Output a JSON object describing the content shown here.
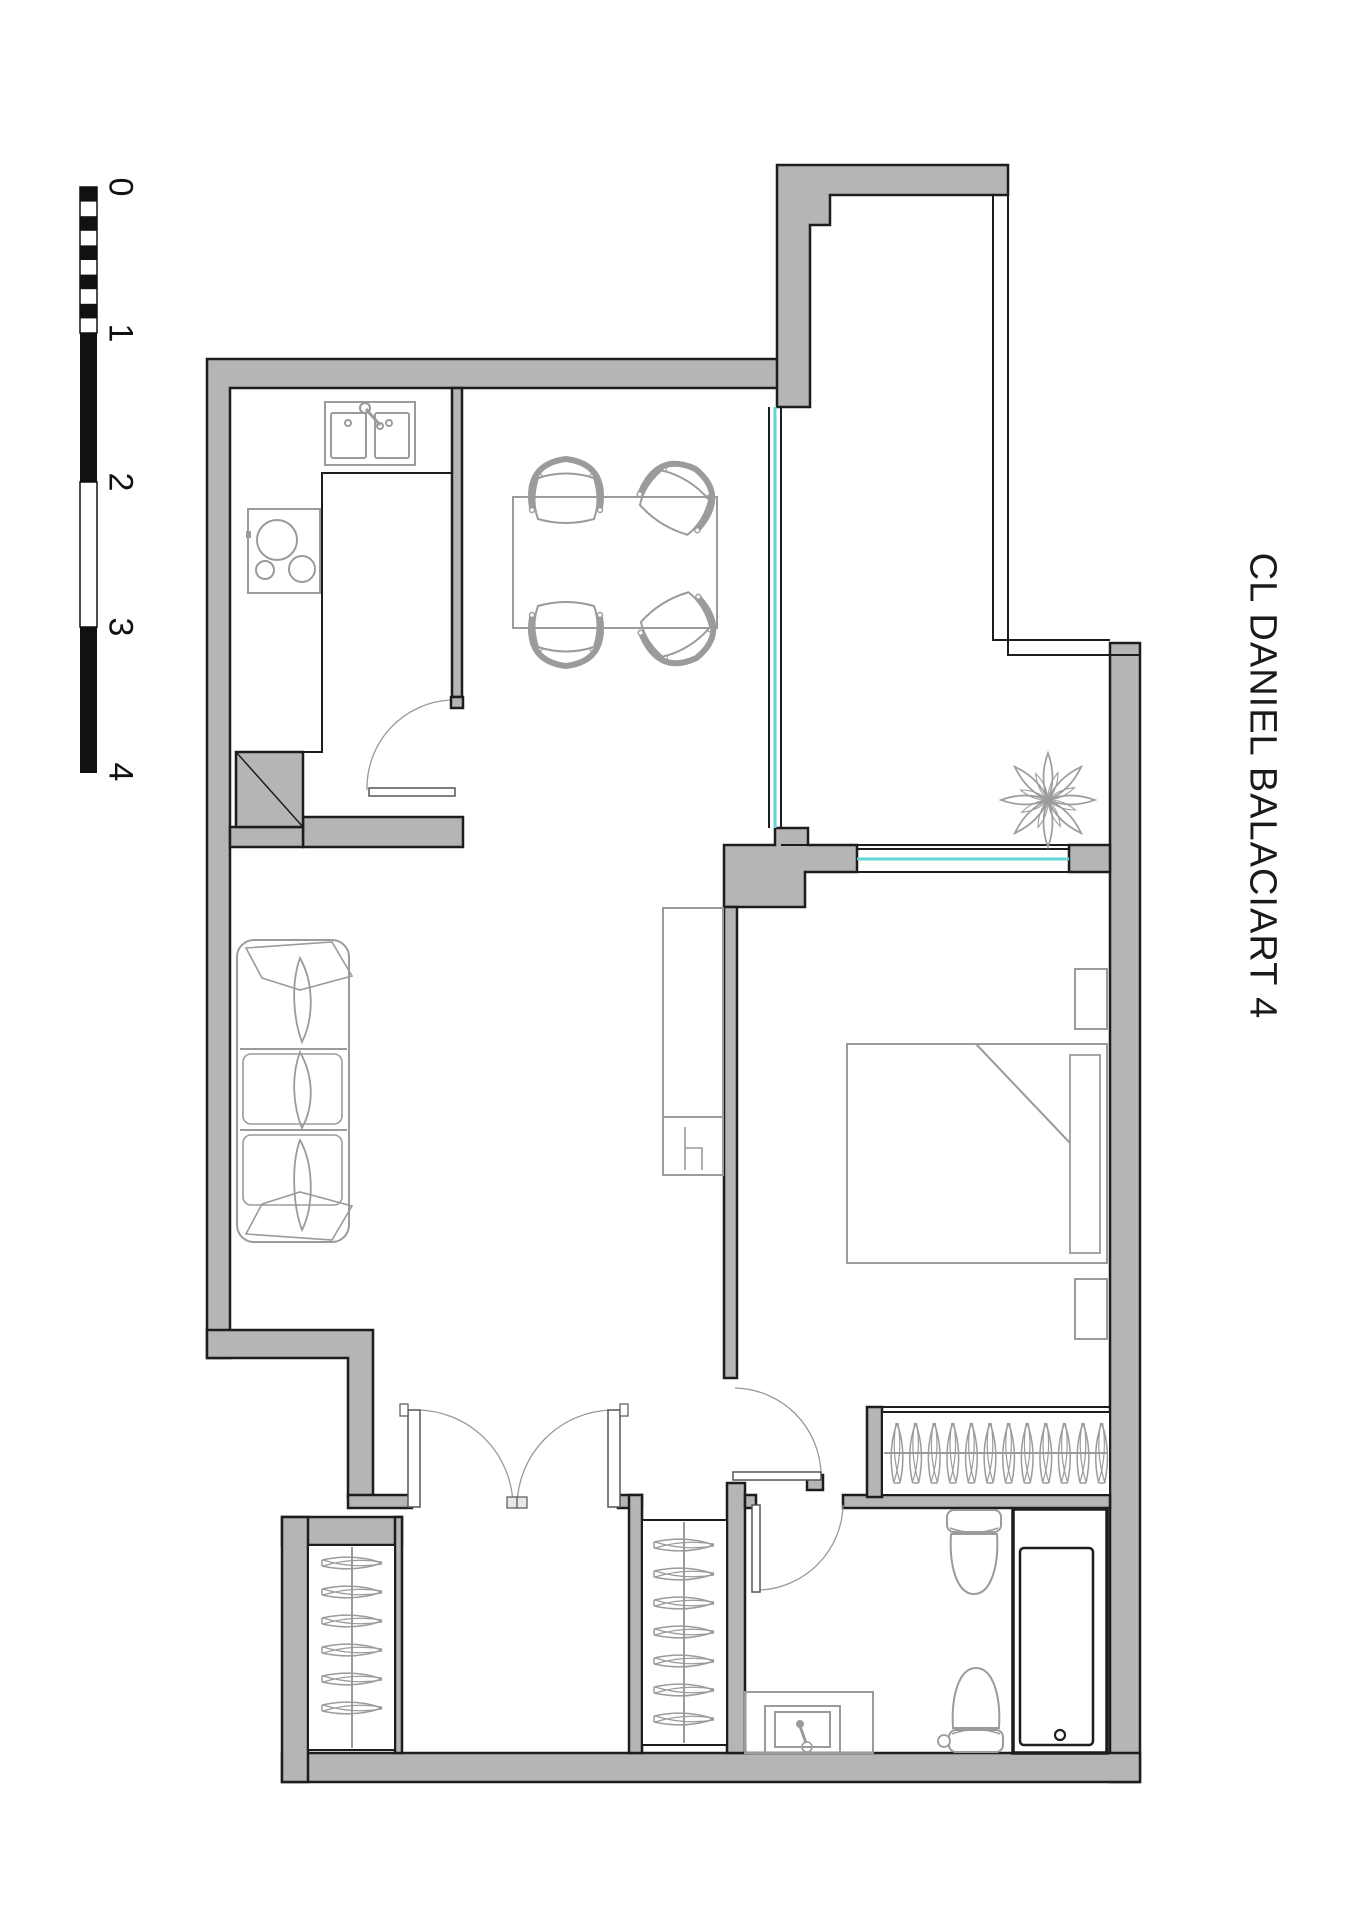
{
  "title": "CL DANIEL BALACIART 4",
  "scale_bar": {
    "labels": [
      "0",
      "1",
      "2",
      "3",
      "4"
    ],
    "tick_y": [
      187,
      333,
      482,
      627,
      772
    ]
  },
  "colors": {
    "wall_fill": "#b5b5b5",
    "outline": "#1d1d1d",
    "furniture": "#9b9b9b",
    "window_glass": "#62d7d7",
    "door_line": "#999999",
    "background": "#ffffff"
  },
  "closets": {
    "wardrobe_hangers": 12,
    "hall_closet_hangers": 7,
    "entry_closet_hangers": 6
  },
  "plant_petals": 8
}
